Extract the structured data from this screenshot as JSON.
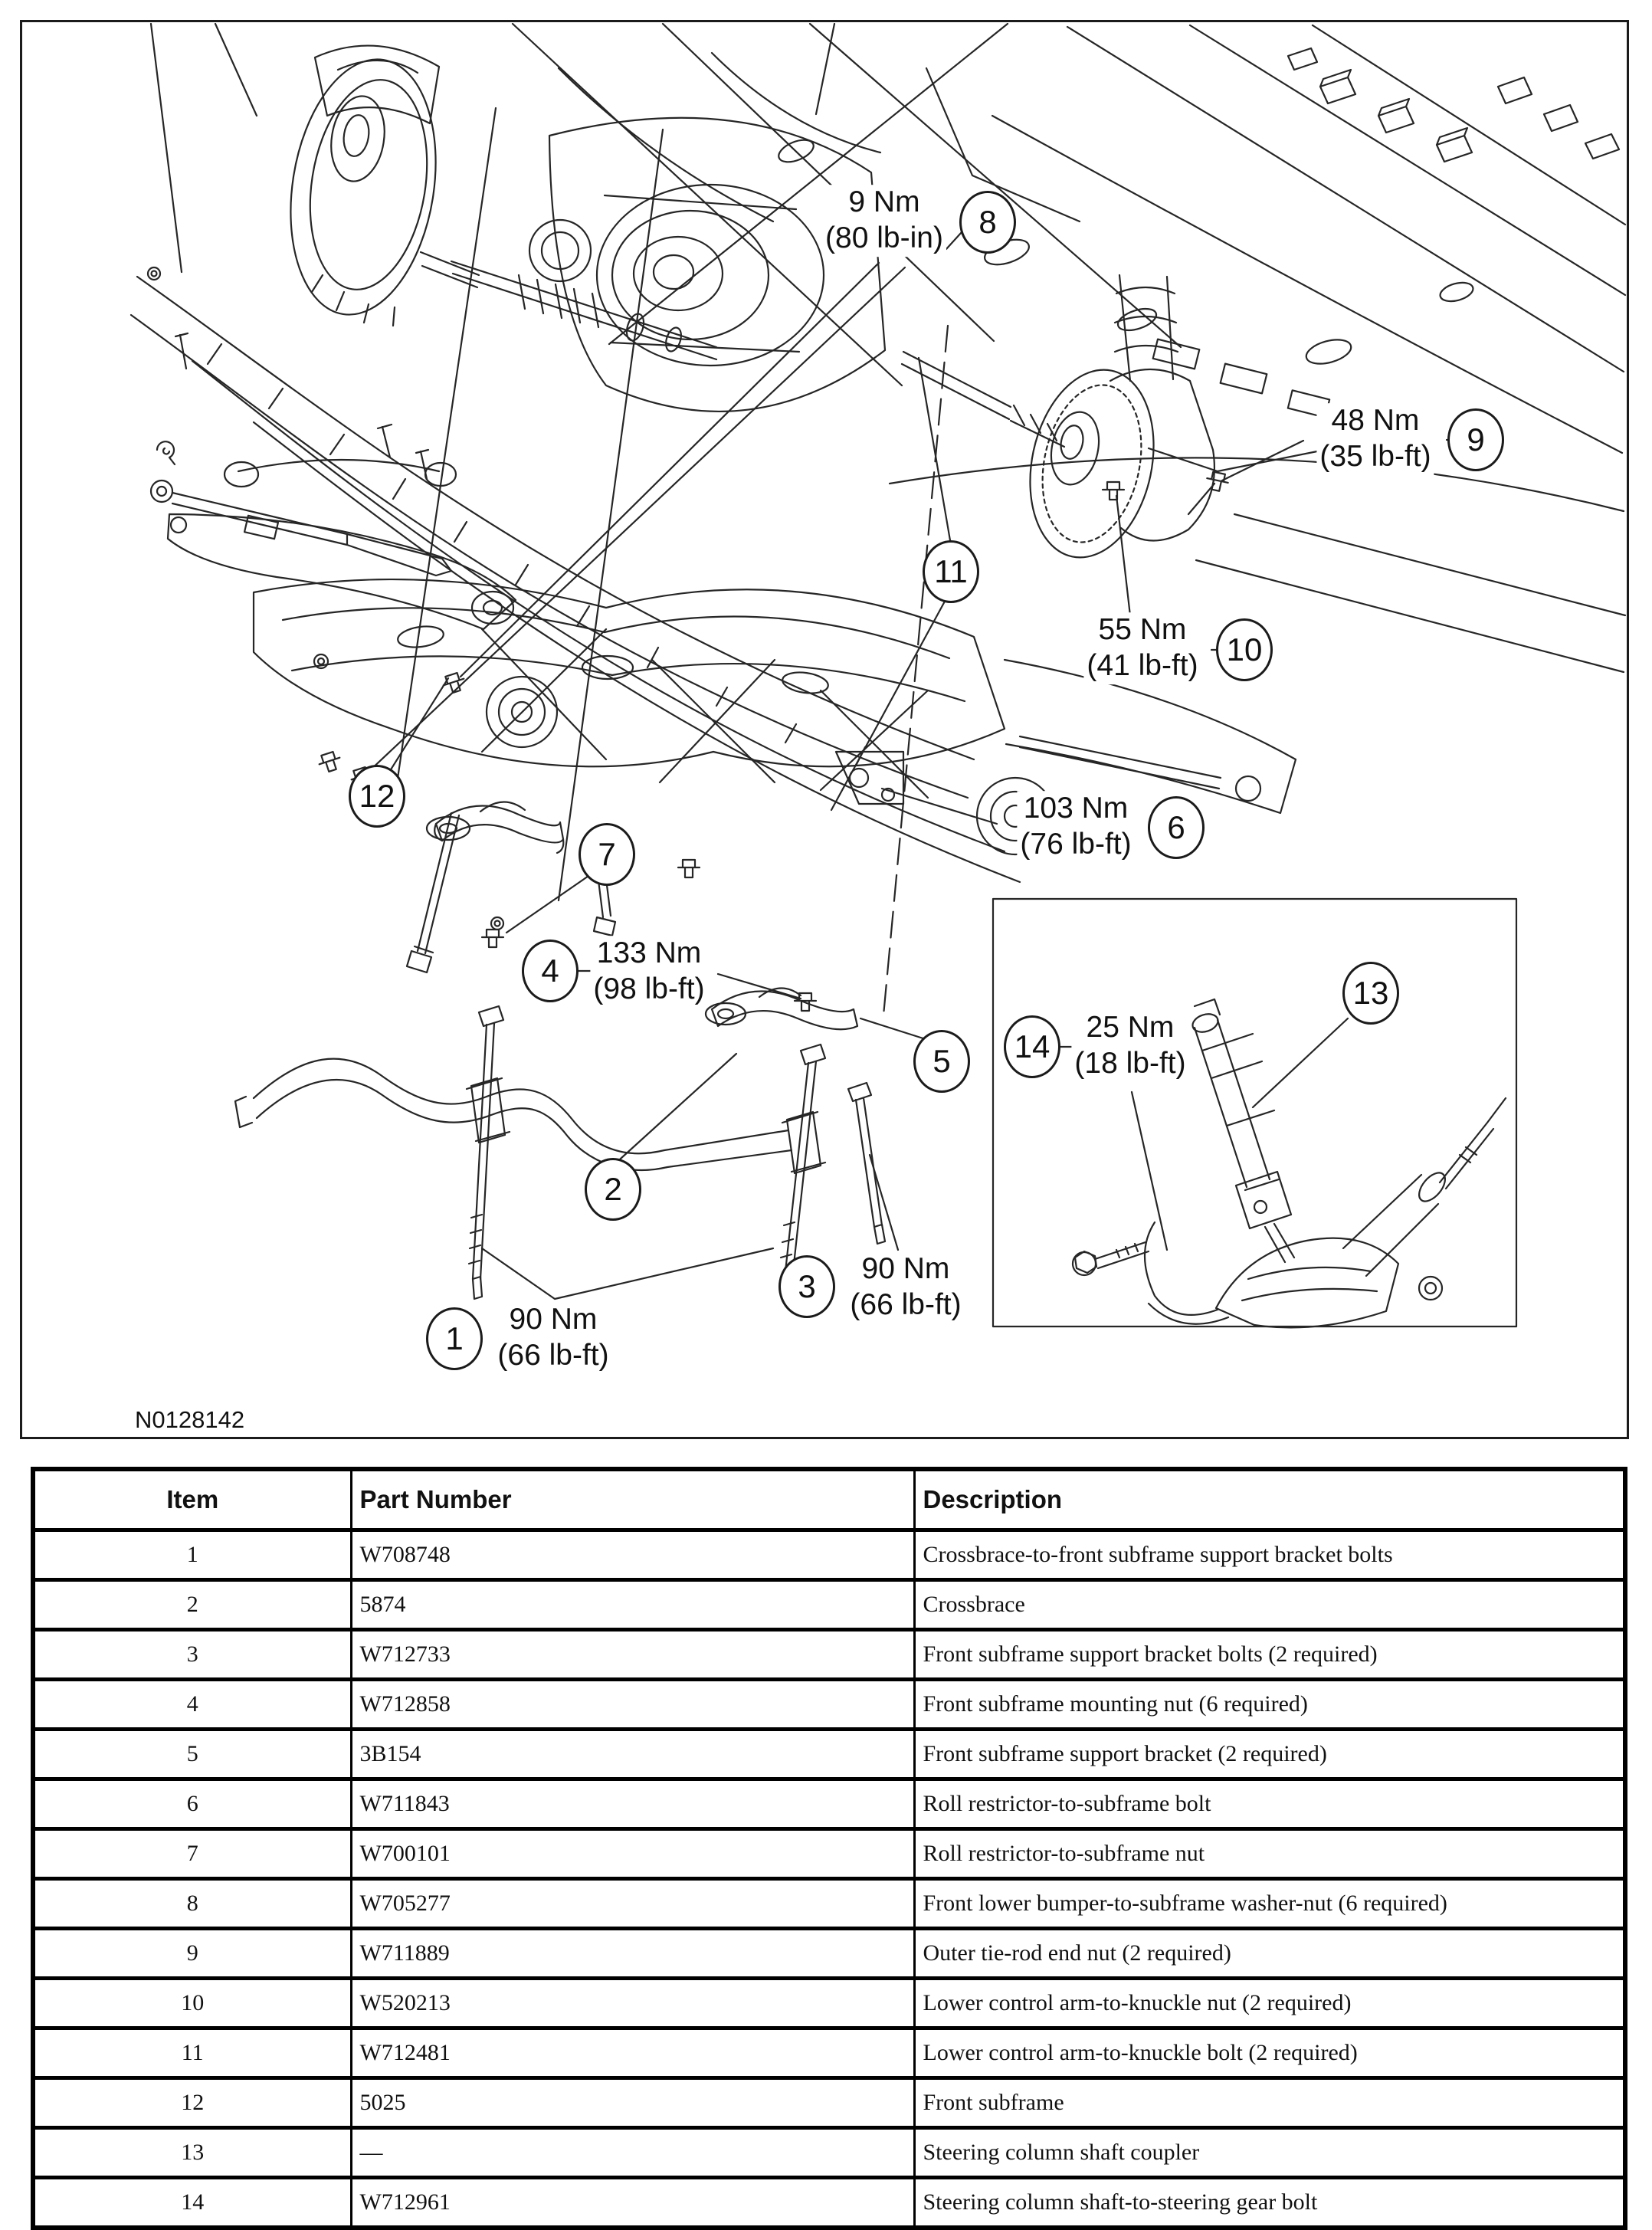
{
  "figure": {
    "id_label": "N0128142",
    "callouts": {
      "c1": "1",
      "c2": "2",
      "c3": "3",
      "c4": "4",
      "c5": "5",
      "c6": "6",
      "c7": "7",
      "c8": "8",
      "c9": "9",
      "c10": "10",
      "c11": "11",
      "c12": "12",
      "c13": "13",
      "c14": "14"
    },
    "torque_labels": {
      "t1": {
        "value": "90 Nm",
        "alt": "(66 lb-ft)"
      },
      "t3": {
        "value": "90 Nm",
        "alt": "(66 lb-ft)"
      },
      "t4": {
        "value": "133 Nm",
        "alt": "(98 lb-ft)"
      },
      "t6": {
        "value": "103 Nm",
        "alt": "(76 lb-ft)"
      },
      "t8": {
        "value": "9 Nm",
        "alt": "(80 lb-in)"
      },
      "t9": {
        "value": "48 Nm",
        "alt": "(35 lb-ft)"
      },
      "t10": {
        "value": "55 Nm",
        "alt": "(41 lb-ft)"
      },
      "t14": {
        "value": "25 Nm",
        "alt": "(18 lb-ft)"
      }
    }
  },
  "table": {
    "headers": [
      "Item",
      "Part Number",
      "Description"
    ],
    "rows": [
      [
        "1",
        "W708748",
        "Crossbrace-to-front subframe support bracket bolts"
      ],
      [
        "2",
        "5874",
        "Crossbrace"
      ],
      [
        "3",
        "W712733",
        "Front subframe support bracket bolts (2 required)"
      ],
      [
        "4",
        "W712858",
        "Front subframe mounting nut (6 required)"
      ],
      [
        "5",
        "3B154",
        "Front subframe support bracket (2 required)"
      ],
      [
        "6",
        "W711843",
        "Roll restrictor-to-subframe bolt"
      ],
      [
        "7",
        "W700101",
        "Roll restrictor-to-subframe nut"
      ],
      [
        "8",
        "W705277",
        "Front lower bumper-to-subframe washer-nut (6 required)"
      ],
      [
        "9",
        "W711889",
        "Outer tie-rod end nut (2 required)"
      ],
      [
        "10",
        "W520213",
        "Lower control arm-to-knuckle nut (2 required)"
      ],
      [
        "11",
        "W712481",
        "Lower control arm-to-knuckle bolt (2 required)"
      ],
      [
        "12",
        "5025",
        "Front subframe"
      ],
      [
        "13",
        "—",
        "Steering column shaft coupler"
      ],
      [
        "14",
        "W712961",
        "Steering column shaft-to-steering gear bolt"
      ]
    ]
  }
}
